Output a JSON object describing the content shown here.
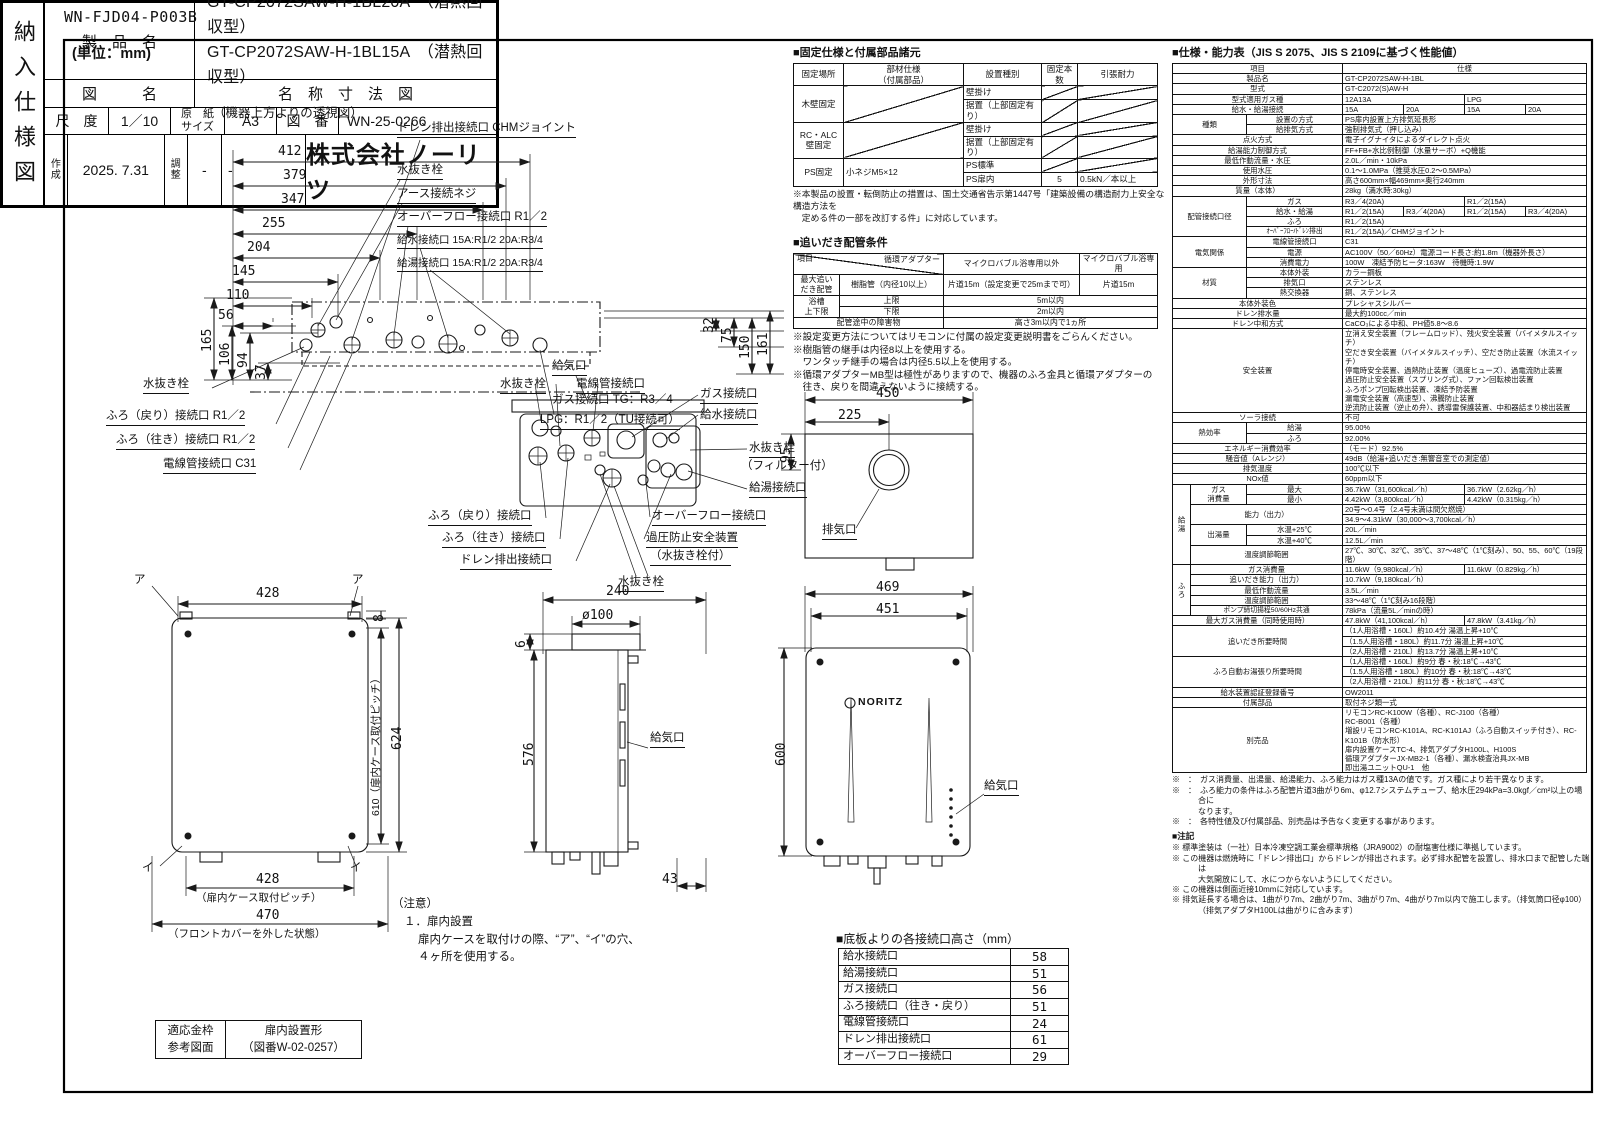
{
  "doc": {
    "code": "WN-FJD04-P003B",
    "unit": "(単位：mm)"
  },
  "topview": {
    "title": "（機器上方よりの透視図）",
    "dh": [
      "412",
      "379",
      "347",
      "255",
      "204",
      "145",
      "110",
      "56"
    ],
    "dvl": [
      "165",
      "106",
      "94",
      "37"
    ],
    "dvr": [
      "32",
      "75",
      "150",
      "161"
    ],
    "lr": [
      "ドレン排出接続口 CHMジョイント",
      "水抜き栓",
      "アース接続ネジ",
      "オーバーフロー接続口 R1／2",
      "給水接続口 15A:R1/2 20A:R3/4",
      "給湯接続口 15A:R1/2 20A:R3/4"
    ],
    "lb": [
      "水抜き栓",
      "ふろ（戻り）接続口 R1／2",
      "ふろ（往き）接続口 R1／2",
      "電線管接続口 C31",
      "ガス接続口 TG：R3／4",
      "LPG：R1／2（TU接続可）"
    ]
  },
  "under": {
    "labels": [
      "給気口",
      "水抜き栓",
      "電線管接続口",
      "ガス接続口",
      "給水接続口",
      "水抜き栓",
      "（フィルター付）",
      "給湯接続口",
      "オーバーフロー接続口",
      "過圧防止安全装置",
      "（水抜き栓付）",
      "ふろ（戻り）接続口",
      "ふろ（往き）接続口",
      "ドレン排出接続口",
      "水抜き栓"
    ]
  },
  "topright": {
    "d450": "450",
    "d225": "225",
    "d95": "95",
    "exhaust": "排気口"
  },
  "frontL": {
    "a": "ア",
    "i": "イ",
    "d428": "428",
    "d8": "8",
    "d624": "624",
    "d610": "610（扉内ケース取付ピッチ）",
    "b428": "428",
    "b428n": "（扉内ケース取付ピッチ）",
    "b470": "470",
    "b470n": "（フロントカバーを外した状態）"
  },
  "side": {
    "d240": "240",
    "dphi": "ø100",
    "d6": "6",
    "d576": "576",
    "d43": "43",
    "intake": "給気口"
  },
  "frontR": {
    "d469": "469",
    "d451": "451",
    "d600": "600",
    "logo": "NORITZ",
    "intake": "給気口"
  },
  "notice": {
    "l1": "（注意）",
    "l2": "１．扉内設置",
    "l3": "扉内ケースを取付けの際、“ア”、“イ”の穴、",
    "l4": "４ヶ所を使用する。"
  },
  "frame": {
    "c1": "適応金枠\n参考図面",
    "c2": "扉内設置形\n（図番W-02-0257）"
  },
  "heights": {
    "title": "■底板よりの各接続口高さ（mm）",
    "rows": [
      [
        "給水接続口",
        "58"
      ],
      [
        "給湯接続口",
        "51"
      ],
      [
        "ガス接続口",
        "56"
      ],
      [
        "ふろ接続口（往き・戻り）",
        "51"
      ],
      [
        "電線管接続口",
        "24"
      ],
      [
        "ドレン排出接続口",
        "61"
      ],
      [
        "オーバーフロー接続口",
        "29"
      ]
    ]
  },
  "fixing": {
    "title": "■固定仕様と付属部品諸元",
    "rows": [
      [
        {
          "t": "固定場所",
          "cls": "c"
        },
        {
          "t": "部材仕様\n（付属部品）",
          "cls": "c"
        },
        {
          "t": "設置種別",
          "cls": "c"
        },
        {
          "t": "固定本数",
          "cls": "c"
        },
        {
          "t": "引張耐力",
          "cls": "c"
        }
      ],
      [
        {
          "t": "木壁固定",
          "rs": 2,
          "cls": "c"
        },
        {
          "t": "",
          "rs": 2,
          "cls": "diag"
        },
        {
          "t": "壁掛け"
        },
        {
          "t": "",
          "cls": "diag"
        },
        {
          "t": "",
          "cls": "diag"
        }
      ],
      [
        {
          "t": "据置（上部固定有り）"
        },
        {
          "t": "",
          "cls": "diag"
        },
        {
          "t": "",
          "cls": "diag"
        }
      ],
      [
        {
          "t": "RC・ALC\n壁固定",
          "rs": 2,
          "cls": "c"
        },
        {
          "t": "",
          "rs": 2,
          "cls": "diag"
        },
        {
          "t": "壁掛け"
        },
        {
          "t": "",
          "cls": "diag"
        },
        {
          "t": "",
          "cls": "diag"
        }
      ],
      [
        {
          "t": "据置（上部固定有り）"
        },
        {
          "t": "",
          "cls": "diag"
        },
        {
          "t": "",
          "cls": "diag"
        }
      ],
      [
        {
          "t": "PS固定",
          "rs": 2,
          "cls": "c"
        },
        {
          "t": "小ネジM5×12",
          "rs": 2
        },
        {
          "t": "PS標準"
        },
        {
          "t": "",
          "cls": "diag"
        },
        {
          "t": "",
          "cls": "diag"
        }
      ],
      [
        {
          "t": "PS扉内"
        },
        {
          "t": "5",
          "cls": "c"
        },
        {
          "t": "0.5kN／本以上"
        }
      ]
    ],
    "note": "※本製品の設置・転倒防止の措置は、国土交通省告示第1447号「建築設備の構造耐力上安全な構造方法を\n　定める件の一部を改訂する件」に対応しています。"
  },
  "piping": {
    "title": "■追いだき配管条件",
    "rows": [
      [
        {
          "t": "項目\n循環アダプター",
          "cs": 2,
          "cls": "split"
        },
        {
          "t": "マイクロバブル浴専用以外",
          "cls": "c"
        },
        {
          "t": "マイクロバブル浴専用",
          "cls": "c"
        }
      ],
      [
        {
          "t": "最大追い\nだき配管",
          "cls": "c"
        },
        {
          "t": "樹脂管（内径10以上）",
          "cls": "c"
        },
        {
          "t": "片道15m（設定変更で25mまで可）",
          "cls": "c"
        },
        {
          "t": "片道15m",
          "cls": "c"
        }
      ],
      [
        {
          "t": "浴槽\n上下限",
          "rs": 2,
          "cls": "c"
        },
        {
          "t": "上限",
          "cls": "c"
        },
        {
          "t": "5m以内",
          "cs": 2,
          "cls": "c"
        }
      ],
      [
        {
          "t": "下限",
          "cls": "c"
        },
        {
          "t": "2m以内",
          "cs": 2,
          "cls": "c"
        }
      ],
      [
        {
          "t": "配管途中の障害物",
          "cs": 2,
          "cls": "c"
        },
        {
          "t": "高さ3m以内で1ヵ所",
          "cs": 2,
          "cls": "c"
        }
      ]
    ],
    "notes": [
      "※設定変更方法についてはリモコンに付属の設定変更説明書をごらんください。",
      "※樹脂管の継手は内径8以上を使用する。",
      "　ワンタッチ継手の場合は内径5.5以上を使用する。",
      "※循環アダプターMB型は極性がありますので、機器のふろ金具と循環アダプターの",
      "　往き、戻りを間違えないように接続する。"
    ]
  },
  "spec": {
    "title": "■仕様・能力表（JIS S 2075、JIS S 2109に基づく性能値）",
    "rows": [
      [
        {
          "t": "項目",
          "cs": 3,
          "cls": "c"
        },
        {
          "t": "仕様",
          "cs": 4,
          "cls": "c"
        }
      ],
      [
        {
          "t": "製品名",
          "cs": 3,
          "cls": "c"
        },
        {
          "t": "GT-CP2072SAW-H-1BL",
          "cs": 4
        }
      ],
      [
        {
          "t": "型式",
          "cs": 3,
          "cls": "c"
        },
        {
          "t": "GT-C2072(S)AW-H",
          "cs": 4
        }
      ],
      [
        {
          "t": "型式適用ガス種",
          "cs": 3,
          "cls": "c"
        },
        {
          "t": "12A13A",
          "cs": 2
        },
        {
          "t": "LPG",
          "cs": 2
        }
      ],
      [
        {
          "t": "給水・給湯接続",
          "cs": 3,
          "cls": "c"
        },
        {
          "t": "15A"
        },
        {
          "t": "20A"
        },
        {
          "t": "15A"
        },
        {
          "t": "20A"
        }
      ],
      [
        {
          "t": "種類",
          "cs": 2,
          "rs": 2,
          "cls": "c"
        },
        {
          "t": "設置の方式",
          "cls": "c"
        },
        {
          "t": "PS扉内設置上方排気延長形",
          "cs": 4
        }
      ],
      [
        {
          "t": "給排気方式",
          "cls": "c"
        },
        {
          "t": "強制排気式（押し込み）",
          "cs": 4
        }
      ],
      [
        {
          "t": "点火方式",
          "cs": 3,
          "cls": "c"
        },
        {
          "t": "電子イグナイタによるダイレクト点火",
          "cs": 4
        }
      ],
      [
        {
          "t": "給湯能力制御方式",
          "cs": 3,
          "cls": "c"
        },
        {
          "t": "FF+FB+水比例制御（水量サーボ）+Q機能",
          "cs": 4
        }
      ],
      [
        {
          "t": "最低作動流量・水圧",
          "cs": 3,
          "cls": "c"
        },
        {
          "t": "2.0L／min・10kPa",
          "cs": 4
        }
      ],
      [
        {
          "t": "使用水圧",
          "cs": 3,
          "cls": "c"
        },
        {
          "t": "0.1～1.0MPa（推奨水圧0.2～0.5MPa）",
          "cs": 4
        }
      ],
      [
        {
          "t": "外形寸法",
          "cs": 3,
          "cls": "c"
        },
        {
          "t": "高さ600mm×幅469mm×奥行240mm",
          "cs": 4
        }
      ],
      [
        {
          "t": "質量（本体）",
          "cs": 3,
          "cls": "c"
        },
        {
          "t": "28kg（満水時:30kg）",
          "cs": 4
        }
      ],
      [
        {
          "t": "配管接続口径",
          "cs": 2,
          "rs": 4,
          "cls": "c"
        },
        {
          "t": "ガス",
          "cls": "c"
        },
        {
          "t": "R3／4(20A)",
          "cs": 2
        },
        {
          "t": "R1／2(15A)",
          "cs": 2
        }
      ],
      [
        {
          "t": "給水・給湯",
          "cls": "c"
        },
        {
          "t": "R1／2(15A)"
        },
        {
          "t": "R3／4(20A)"
        },
        {
          "t": "R1／2(15A)"
        },
        {
          "t": "R3／4(20A)"
        }
      ],
      [
        {
          "t": "ふろ",
          "cls": "c"
        },
        {
          "t": "R1／2(15A)",
          "cs": 4
        }
      ],
      [
        {
          "t": "ｵｰﾊﾞｰﾌﾛｰ/ﾄﾞﾚﾝ排出",
          "cls": "c s"
        },
        {
          "t": "R1／2(15A)／CHMジョイント",
          "cs": 4
        }
      ],
      [
        {
          "t": "電気関係",
          "cs": 2,
          "rs": 3,
          "cls": "c"
        },
        {
          "t": "電線管接続口",
          "cls": "c"
        },
        {
          "t": "C31",
          "cs": 4
        }
      ],
      [
        {
          "t": "電源",
          "cls": "c"
        },
        {
          "t": "AC100V（50／60Hz）電源コード長さ:約1.8m（機器外長さ）",
          "cs": 4
        }
      ],
      [
        {
          "t": "消費電力",
          "cls": "c"
        },
        {
          "t": "100W　凍結予防ヒータ:163W　待機時:1.9W",
          "cs": 4
        }
      ],
      [
        {
          "t": "材質",
          "cs": 2,
          "rs": 3,
          "cls": "c"
        },
        {
          "t": "本体外装",
          "cls": "c"
        },
        {
          "t": "カラー鋼板",
          "cs": 4
        }
      ],
      [
        {
          "t": "排気口",
          "cls": "c"
        },
        {
          "t": "ステンレス",
          "cs": 4
        }
      ],
      [
        {
          "t": "熱交換器",
          "cls": "c"
        },
        {
          "t": "銅、ステンレス",
          "cs": 4
        }
      ],
      [
        {
          "t": "本体外装色",
          "cs": 3,
          "cls": "c"
        },
        {
          "t": "プレシャスシルバー",
          "cs": 4
        }
      ],
      [
        {
          "t": "ドレン排水量",
          "cs": 3,
          "cls": "c"
        },
        {
          "t": "最大約100cc／min",
          "cs": 4
        }
      ],
      [
        {
          "t": "ドレン中和方式",
          "cs": 3,
          "cls": "c"
        },
        {
          "t": "CaCO₃による中和、PH値5.8～8.6",
          "cs": 4
        }
      ],
      [
        {
          "t": "安全装置",
          "cs": 3,
          "cls": "c"
        },
        {
          "t": "立消え安全装置（フレームロッド）、残火安全装置（バイメタルスイッチ）\n空だき安全装置（バイメタルスイッチ）、空だき防止装置（水流スイッチ）\n停電時安全装置、過熱防止装置（温度ヒューズ）、過電流防止装置\n過圧防止安全装置（スプリング式）、ファン回転検出装置\nふろポンプ回転検出装置、凍結予防装置\n漏電安全装置（高速型）、沸騰防止装置\n逆流防止装置（逆止め弁）、誘導雷保護装置、中和器詰まり検出装置",
          "cs": 4
        }
      ],
      [
        {
          "t": "ソーラ接続",
          "cs": 3,
          "cls": "c"
        },
        {
          "t": "不可",
          "cs": 4
        }
      ],
      [
        {
          "t": "熱効率",
          "cs": 2,
          "rs": 2,
          "cls": "c"
        },
        {
          "t": "給湯",
          "cls": "c"
        },
        {
          "t": "95.00%",
          "cs": 4
        }
      ],
      [
        {
          "t": "ふろ",
          "cls": "c"
        },
        {
          "t": "92.00%",
          "cs": 4
        }
      ],
      [
        {
          "t": "エネルギー消費効率",
          "cs": 3,
          "cls": "c"
        },
        {
          "t": "（モード）92.5%",
          "cs": 4
        }
      ],
      [
        {
          "t": "騒音値（Aレンジ）",
          "cs": 3,
          "cls": "c"
        },
        {
          "t": "49dB（給湯+追いだき:無響音室での測定値）",
          "cs": 4
        }
      ],
      [
        {
          "t": "排気温度",
          "cs": 3,
          "cls": "c"
        },
        {
          "t": "100℃以下",
          "cs": 4
        }
      ],
      [
        {
          "t": "NOx値",
          "cs": 3,
          "cls": "c"
        },
        {
          "t": "60ppm以下",
          "cs": 4
        }
      ],
      [
        {
          "t": "給湯",
          "rs": 7,
          "cls": "c vert"
        },
        {
          "t": "ガス\n消費量",
          "rs": 2,
          "cls": "c"
        },
        {
          "t": "最大",
          "cls": "c"
        },
        {
          "t": "36.7kW（31,600kcal／h）",
          "cs": 2
        },
        {
          "t": "36.7kW（2.62kg／h）",
          "cs": 2
        }
      ],
      [
        {
          "t": "最小",
          "cls": "c"
        },
        {
          "t": "4.42kW（3,800kcal／h）",
          "cs": 2
        },
        {
          "t": "4.42kW（0.315kg／h）",
          "cs": 2
        }
      ],
      [
        {
          "t": "能力（出力）",
          "cs": 2,
          "rs": 2,
          "cls": "c"
        },
        {
          "t": "20号～0.4号（2.4号未満は間欠燃焼）",
          "cs": 4
        }
      ],
      [
        {
          "t": "34.9～4.31kW（30,000～3,700kcal／h）",
          "cs": 4
        }
      ],
      [
        {
          "t": "出湯量",
          "rs": 2,
          "cls": "c"
        },
        {
          "t": "水温+25℃",
          "cls": "c"
        },
        {
          "t": "20L／min",
          "cs": 4
        }
      ],
      [
        {
          "t": "水温+40℃",
          "cls": "c"
        },
        {
          "t": "12.5L／min",
          "cs": 4
        }
      ],
      [
        {
          "t": "温度調節範囲",
          "cs": 2,
          "cls": "c"
        },
        {
          "t": "27℃、30℃、32℃、35℃、37～48℃（1℃刻み）、50、55、60℃（19段階）",
          "cs": 4
        }
      ],
      [
        {
          "t": "ふろ",
          "rs": 5,
          "cls": "c vert"
        },
        {
          "t": "ガス消費量",
          "cs": 2,
          "cls": "c"
        },
        {
          "t": "11.6kW（9,980kcal／h）",
          "cs": 2
        },
        {
          "t": "11.6kW（0.829kg／h）",
          "cs": 2
        }
      ],
      [
        {
          "t": "追いだき能力（出力）",
          "cs": 2,
          "cls": "c"
        },
        {
          "t": "10.7kW（9,180kcal／h）",
          "cs": 4
        }
      ],
      [
        {
          "t": "最低作動流量",
          "cs": 2,
          "cls": "c"
        },
        {
          "t": "3.5L／min",
          "cs": 4
        }
      ],
      [
        {
          "t": "温度調節範囲",
          "cs": 2,
          "cls": "c"
        },
        {
          "t": "33～48℃（1℃刻み16段階）",
          "cs": 4
        }
      ],
      [
        {
          "t": "ポンプ締切揚程50/60Hz共通",
          "cs": 2,
          "cls": "c s"
        },
        {
          "t": "78kPa（流量5L／minの時）",
          "cs": 4
        }
      ],
      [
        {
          "t": "最大ガス消費量（同時使用時）",
          "cs": 3,
          "cls": "c"
        },
        {
          "t": "47.8kW（41,100kcal／h）",
          "cs": 2
        },
        {
          "t": "47.8kW（3.41kg／h）",
          "cs": 2
        }
      ],
      [
        {
          "t": "追いだき所要時間",
          "cs": 3,
          "rs": 3,
          "cls": "c"
        },
        {
          "t": "（1人用浴槽・160L）約10.4分 湯温上昇+10℃",
          "cs": 4
        }
      ],
      [
        {
          "t": "（1.5人用浴槽・180L）約11.7分 湯温上昇+10℃",
          "cs": 4
        }
      ],
      [
        {
          "t": "（2人用浴槽・210L）約13.7分 湯温上昇+10℃",
          "cs": 4
        }
      ],
      [
        {
          "t": "ふろ自動お湯張り所要時間",
          "cs": 3,
          "rs": 3,
          "cls": "c"
        },
        {
          "t": "（1人用浴槽・160L）約9分 春・秋:18℃→43℃",
          "cs": 4
        }
      ],
      [
        {
          "t": "（1.5人用浴槽・180L）約10分 春・秋:18℃→43℃",
          "cs": 4
        }
      ],
      [
        {
          "t": "（2人用浴槽・210L）約11分 春・秋:18℃→43℃",
          "cs": 4
        }
      ],
      [
        {
          "t": "給水装置認証登録番号",
          "cs": 3,
          "cls": "c"
        },
        {
          "t": "OW2011",
          "cs": 4
        }
      ],
      [
        {
          "t": "付属部品",
          "cs": 3,
          "cls": "c"
        },
        {
          "t": "取付ネジ類一式",
          "cs": 4
        }
      ],
      [
        {
          "t": "別売品",
          "cs": 3,
          "cls": "c"
        },
        {
          "t": "リモコンRC-K100W（各種）、RC-J100（各種）\nRC-B001（各種）\n増設リモコンRC-K101A、RC-K101AJ（ふろ自動スイッチ付き）、RC-K101B（防水形）\n扉内設置ケースTC-4、排気アダプタH100L、H100S\n循環アダプターJX-MB2-1（各種）、漏水検査治具JX-MB\n即出湯ユニットQU-1　他",
          "cs": 4
        }
      ]
    ],
    "notes": [
      "※　：　ガス消費量、出湯量、給湯能力、ふろ能力はガス種13Aの値です。ガス種により若干異なります。",
      "※　：　ふろ能力の条件はふろ配管片道3曲がり6m、φ12.7システムチューブ、給水圧294kPa=3.0kgf／cm²以上の場合に\nなります。",
      "※　：　各特性値及び付属部品、別売品は予告なく変更する事があります。"
    ],
    "notes2_title": "■注記",
    "notes2": [
      "※ 標準塗装は（一社）日本冷凍空調工業会標準規格（JRA9002）の耐塩害仕様に準拠しています。",
      "※ この機器は燃焼時に「ドレン排出口」からドレンが排出されます。必ず排水配管を設置し、排水口まで配管した端は\n大気開放にして、水につからないようにしてください。",
      "※ この機器は側面近接10mmに対応しています。",
      "※ 排気延長する場合は、1曲がり7m、2曲がり7m、3曲がり7m、4曲がり7m以内で施工します。（排気筒口径φ100）\n（排気アダプタH100Lは曲がりに含みます）"
    ]
  },
  "tblock": {
    "vert": "納入仕様図",
    "p_label": "製　品　名",
    "p1": "GT-CP2072SAW-H-1BL20A　（潜熱回収型）",
    "p2": "GT-CP2072SAW-H-1BL15A　（潜熱回収型）",
    "z_label": "図　　　名",
    "z_value": "名　称　寸　法　図",
    "scale_label": "尺　度",
    "scale": "1／10",
    "paper_label": "原　紙\nサイズ",
    "paper": "A3",
    "no_label": "図　番",
    "no": "WN-25-0266",
    "made_label": "作\n成",
    "made": "2025. 7.31",
    "adj_label": "調\n整",
    "adj1": "-",
    "adj2": "-",
    "company": "株式会社ノーリツ"
  }
}
